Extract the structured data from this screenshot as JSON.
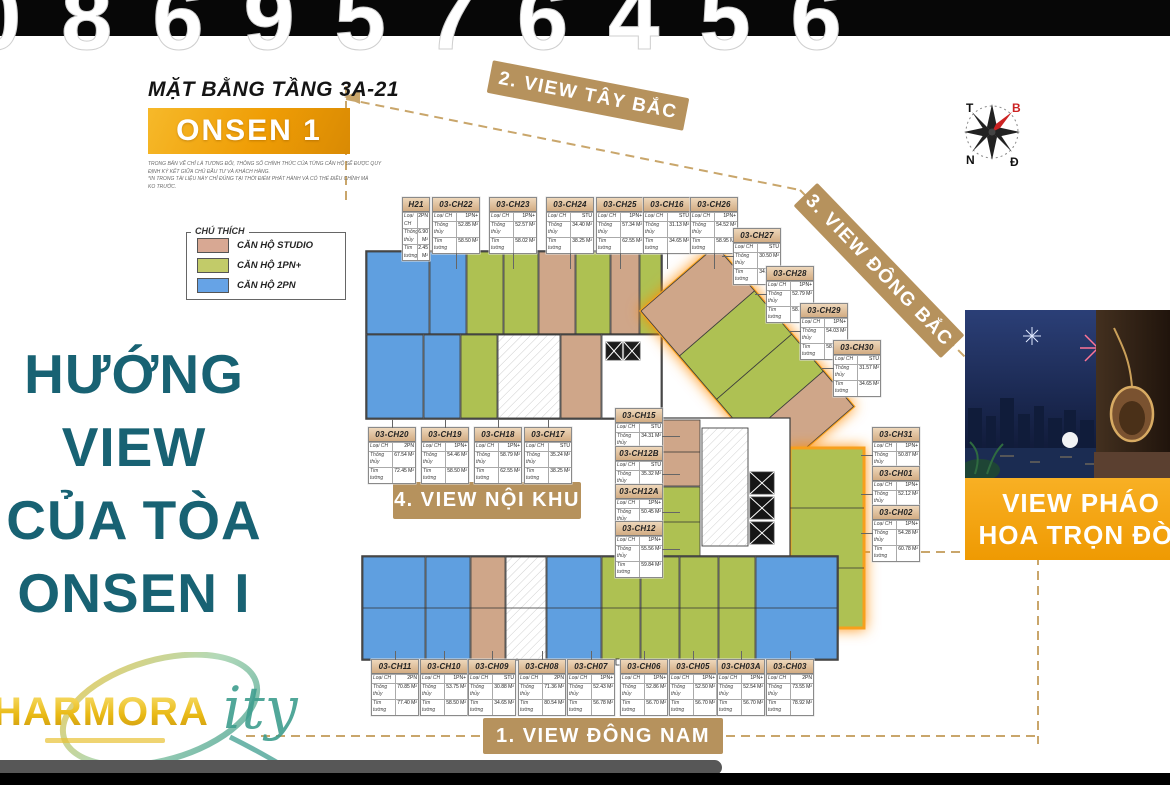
{
  "watermark": {
    "digits": "0869576456"
  },
  "header": {
    "title": "MẶT BẰNG TẦNG 3A-21",
    "building": "ONSEN 1",
    "disclaimer": [
      "TRONG BẢN VẼ CHỈ LÀ TƯƠNG ĐỐI, THÔNG SỐ CHÍNH THỨC CỦA TỪNG CĂN HỘ SẼ ĐƯỢC QUY",
      "ĐỊNH KÝ KẾT GIỮA CHỦ ĐẦU TƯ VÀ KHÁCH HÀNG.",
      "*IN TRONG TÀI LIỆU NÀY CHỈ ĐÚNG TẠI THỜI ĐIỂM PHÁT HÀNH VÀ CÓ THỂ ĐIỀU CHỈNH MÀ",
      "KO TRƯỚC."
    ]
  },
  "legend": {
    "title": "CHÚ THÍCH",
    "items": [
      {
        "label": "CĂN HỘ STUDIO",
        "color": "#d8a893"
      },
      {
        "label": "CĂN HỘ 1PN+",
        "color": "#c2cb69"
      },
      {
        "label": "CĂN HỘ 2PN",
        "color": "#66a3e6"
      }
    ]
  },
  "side_title": {
    "lines": [
      "HƯỚNG",
      "VIEW",
      "CỦA TÒA",
      "ONSEN I"
    ],
    "color": "#186273"
  },
  "banners": {
    "view1": "1. VIEW ĐÔNG NAM",
    "view2": "2. VIEW TÂY BẮC",
    "view3": "3. VIEW ĐÔNG BẮC",
    "view4": "4. VIEW NỘI KHU"
  },
  "compass": {
    "west": "T",
    "north": "B",
    "south": "N",
    "east": "Đ"
  },
  "callout": {
    "line1": "VIEW PHÁO",
    "line2": "HOA TRỌN ĐỜI"
  },
  "logo": {
    "word": "HARMORA",
    "script": "ity"
  },
  "unit_fields": {
    "type_label": "Loại CH",
    "net_label": "Thông thủy",
    "gross_label": "Tim tường"
  },
  "units": [
    {
      "id": "03-CH21",
      "display": "H21",
      "type": "2PN",
      "net": "6.90 M²",
      "gross": "2.45 M²"
    },
    {
      "id": "03-CH22",
      "display": "03-CH22",
      "type": "1PN+",
      "net": "52.85 M²",
      "gross": "58.50 M²"
    },
    {
      "id": "03-CH23",
      "display": "03-CH23",
      "type": "1PN+",
      "net": "52.57 M²",
      "gross": "58.02 M²"
    },
    {
      "id": "03-CH24",
      "display": "03-CH24",
      "type": "STU",
      "net": "34.40 M²",
      "gross": "38.25 M²"
    },
    {
      "id": "03-CH25",
      "display": "03-CH25",
      "type": "1PN+",
      "net": "57.34 M²",
      "gross": "62.55 M²"
    },
    {
      "id": "03-CH16",
      "display": "03-CH16",
      "type": "STU",
      "net": "31.13 M²",
      "gross": "34.65 M²"
    },
    {
      "id": "03-CH26",
      "display": "03-CH26",
      "type": "1PN+",
      "net": "54.52 M²",
      "gross": "58.95 M²"
    },
    {
      "id": "03-CH27",
      "display": "03-CH27",
      "type": "STU",
      "net": "30.50 M²",
      "gross": "34.55 M²"
    },
    {
      "id": "03-CH28",
      "display": "03-CH28",
      "type": "1PN+",
      "net": "52.79 M²",
      "gross": "58.50 M²"
    },
    {
      "id": "03-CH29",
      "display": "03-CH29",
      "type": "1PN+",
      "net": "54.03 M²",
      "gross": "58.50 M²"
    },
    {
      "id": "03-CH30",
      "display": "03-CH30",
      "type": "STU",
      "net": "31.57 M²",
      "gross": "34.65 M²"
    },
    {
      "id": "03-CH20",
      "display": "03-CH20",
      "type": "2PN",
      "net": "67.54 M²",
      "gross": "72.45 M²"
    },
    {
      "id": "03-CH19",
      "display": "03-CH19",
      "type": "1PN+",
      "net": "54.46 M²",
      "gross": "58.50 M²"
    },
    {
      "id": "03-CH18",
      "display": "03-CH18",
      "type": "1PN+",
      "net": "58.79 M²",
      "gross": "62.55 M²"
    },
    {
      "id": "03-CH17",
      "display": "03-CH17",
      "type": "STU",
      "net": "35.24 M²",
      "gross": "38.25 M²"
    },
    {
      "id": "03-CH15",
      "display": "03-CH15",
      "type": "STU",
      "net": "34.31 M²",
      "gross": "38.48 M²"
    },
    {
      "id": "03-CH12B",
      "display": "03-CH12B",
      "type": "STU",
      "net": "35.32 M²",
      "gross": "37.91 M²"
    },
    {
      "id": "03-CH12A",
      "display": "03-CH12A",
      "type": "1PN+",
      "net": "50.45 M²",
      "gross": "54.28 M²"
    },
    {
      "id": "03-CH12",
      "display": "03-CH12",
      "type": "1PN+",
      "net": "55.56 M²",
      "gross": "59.84 M²"
    },
    {
      "id": "03-CH31",
      "display": "03-CH31",
      "type": "1PN+",
      "net": "50.87 M²",
      "gross": "54.18 M²"
    },
    {
      "id": "03-CH01",
      "display": "03-CH01",
      "type": "1PN+",
      "net": "52.12 M²",
      "gross": "58.50 M²"
    },
    {
      "id": "03-CH02",
      "display": "03-CH02",
      "type": "1PN+",
      "net": "54.28 M²",
      "gross": "60.78 M²"
    },
    {
      "id": "03-CH11",
      "display": "03-CH11",
      "type": "2PN",
      "net": "70.85 M²",
      "gross": "77.40 M²"
    },
    {
      "id": "03-CH10",
      "display": "03-CH10",
      "type": "1PN+",
      "net": "53.75 M²",
      "gross": "58.50 M²"
    },
    {
      "id": "03-CH09",
      "display": "03-CH09",
      "type": "STU",
      "net": "30.88 M²",
      "gross": "34.65 M²"
    },
    {
      "id": "03-CH08",
      "display": "03-CH08",
      "type": "2PN",
      "net": "71.36 M²",
      "gross": "80.54 M²"
    },
    {
      "id": "03-CH07",
      "display": "03-CH07",
      "type": "1PN+",
      "net": "52.43 M²",
      "gross": "56.78 M²"
    },
    {
      "id": "03-CH06",
      "display": "03-CH06",
      "type": "1PN+",
      "net": "52.86 M²",
      "gross": "56.70 M²"
    },
    {
      "id": "03-CH05",
      "display": "03-CH05",
      "type": "1PN+",
      "net": "52.50 M²",
      "gross": "56.70 M²"
    },
    {
      "id": "03-CH03A",
      "display": "03-CH03A",
      "type": "1PN+",
      "net": "52.54 M²",
      "gross": "56.70 M²"
    },
    {
      "id": "03-CH03",
      "display": "03-CH03",
      "type": "2PN",
      "net": "73.55 M²",
      "gross": "78.92 M²"
    }
  ],
  "plan_colors": {
    "studio": "#cfa689",
    "pn1": "#aec152",
    "pn2": "#5f9fe0",
    "highlight": "#f7a01d"
  }
}
